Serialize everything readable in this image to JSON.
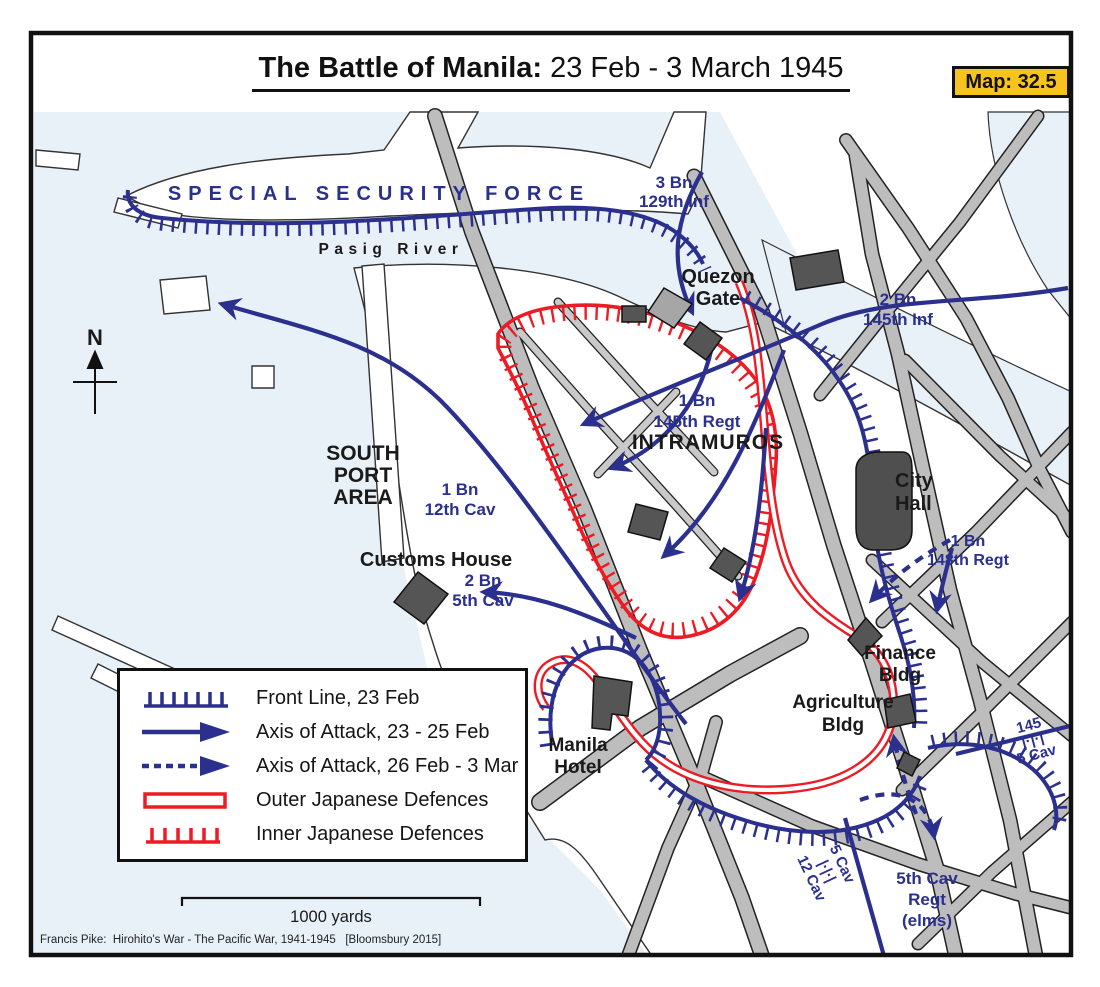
{
  "title": {
    "bold": "The Battle of Manila:",
    "rest": " 23 Feb - 3 March 1945"
  },
  "badge": {
    "label": "Map: 32.5"
  },
  "attribution": "Francis Pike:  Hirohito's War - The Pacific War, 1941-1945   [Bloomsbury 2015]",
  "colors": {
    "navy": "#2b2f8e",
    "red": "#ec1b24",
    "water": "#e8f1f8",
    "road": "#bdbdbd",
    "road_minor": "#c9c9c9",
    "building": "#555555",
    "badge_bg": "#f6c41c",
    "ink": "#1a1a1a"
  },
  "legend": {
    "items": [
      {
        "symbol": "front-line-icon",
        "label": "Front Line, 23 Feb"
      },
      {
        "symbol": "axis-solid-icon",
        "label": "Axis of Attack, 23 - 25 Feb"
      },
      {
        "symbol": "axis-dashed-icon",
        "label": "Axis of Attack, 26 Feb - 3 Mar"
      },
      {
        "symbol": "outer-defences-icon",
        "label": "Outer Japanese Defences"
      },
      {
        "symbol": "inner-defences-icon",
        "label": "Inner Japanese Defences"
      }
    ]
  },
  "map": {
    "labels": [
      {
        "id": "special-security-force",
        "lines": [
          "SPECIAL SECURITY FORCE"
        ],
        "x": 379,
        "y": 200,
        "size": 20,
        "color": "navy",
        "weight": 700,
        "spacing": 7
      },
      {
        "id": "pasig-river",
        "lines": [
          "Pasig River"
        ],
        "x": 391,
        "y": 254,
        "size": 15.5,
        "color": "ink",
        "weight": 700,
        "spacing": 5.5
      },
      {
        "id": "unit-3bn-129inf",
        "lines": [
          "3 Bn",
          "129th Inf"
        ],
        "x": 674,
        "y": 188,
        "size": 17,
        "color": "navy",
        "lh": 19
      },
      {
        "id": "quezon-gate",
        "lines": [
          "Quezon",
          "Gate"
        ],
        "x": 718,
        "y": 283,
        "size": 20,
        "color": "ink",
        "lh": 22
      },
      {
        "id": "unit-2bn-145inf",
        "lines": [
          "2 Bn",
          "145th Inf"
        ],
        "x": 898,
        "y": 305,
        "size": 17,
        "color": "navy",
        "lh": 20
      },
      {
        "id": "unit-1bn-145regt",
        "lines": [
          "1 Bn",
          "145th Regt"
        ],
        "x": 697,
        "y": 406,
        "size": 17,
        "color": "navy",
        "lh": 21
      },
      {
        "id": "intramuros",
        "lines": [
          "INTRAMUROS"
        ],
        "x": 708,
        "y": 449,
        "size": 21,
        "color": "ink",
        "spacing": 1
      },
      {
        "id": "city-hall",
        "lines": [
          "City",
          "Hall"
        ],
        "x": 895,
        "y": 487,
        "size": 20,
        "color": "ink",
        "lh": 23,
        "anchor": "start"
      },
      {
        "id": "south-port-area",
        "lines": [
          "SOUTH",
          "PORT",
          "AREA"
        ],
        "x": 363,
        "y": 460,
        "size": 21,
        "color": "ink",
        "lh": 22
      },
      {
        "id": "unit-1bn-12cav",
        "lines": [
          "1 Bn",
          "12th Cav"
        ],
        "x": 460,
        "y": 495,
        "size": 17,
        "color": "navy",
        "lh": 20
      },
      {
        "id": "customs-house",
        "lines": [
          "Customs House"
        ],
        "x": 436,
        "y": 566,
        "size": 20,
        "color": "ink"
      },
      {
        "id": "unit-2bn-5cav",
        "lines": [
          "2 Bn",
          "5th Cav"
        ],
        "x": 483,
        "y": 586,
        "size": 17,
        "color": "navy",
        "lh": 20
      },
      {
        "id": "unit-1bn-148regt",
        "lines": [
          "1 Bn",
          "148th Regt"
        ],
        "x": 968,
        "y": 546,
        "size": 16,
        "color": "navy",
        "lh": 19
      },
      {
        "id": "finance-bldg",
        "lines": [
          "Finance",
          "Bldg"
        ],
        "x": 900,
        "y": 659,
        "size": 19,
        "color": "ink",
        "lh": 22
      },
      {
        "id": "agriculture-bldg",
        "lines": [
          "Agriculture",
          "Bldg"
        ],
        "x": 843,
        "y": 708,
        "size": 19,
        "color": "ink",
        "lh": 23
      },
      {
        "id": "manila-hotel",
        "lines": [
          "Manila",
          "Hotel"
        ],
        "x": 578,
        "y": 751,
        "size": 19,
        "color": "ink",
        "lh": 22
      },
      {
        "id": "boundary-145-5cav",
        "lines": [
          "145",
          "|·|·|",
          "5 Cav"
        ],
        "x": 1030,
        "y": 730,
        "size": 15,
        "color": "navy",
        "lh": 15,
        "rotate": -15
      },
      {
        "id": "boundary-5cav-12cav",
        "lines": [
          "5 Cav",
          "|·|·|",
          "12 Cav"
        ],
        "x": 838,
        "y": 866,
        "size": 15,
        "color": "navy",
        "lh": 17,
        "rotate": 65
      },
      {
        "id": "unit-5th-cav-regt-elms",
        "lines": [
          "5th Cav",
          "Regt",
          "(elms)"
        ],
        "x": 927,
        "y": 884,
        "size": 17,
        "color": "navy",
        "lh": 21
      },
      {
        "id": "compass-letter",
        "lines": [
          "N"
        ],
        "x": 95,
        "y": 345,
        "size": 22,
        "color": "ink",
        "weight": 600
      },
      {
        "id": "scale-label",
        "lines": [
          "1000 yards"
        ],
        "x": 331,
        "y": 922,
        "size": 16.5,
        "color": "ink",
        "weight": 500
      }
    ]
  }
}
